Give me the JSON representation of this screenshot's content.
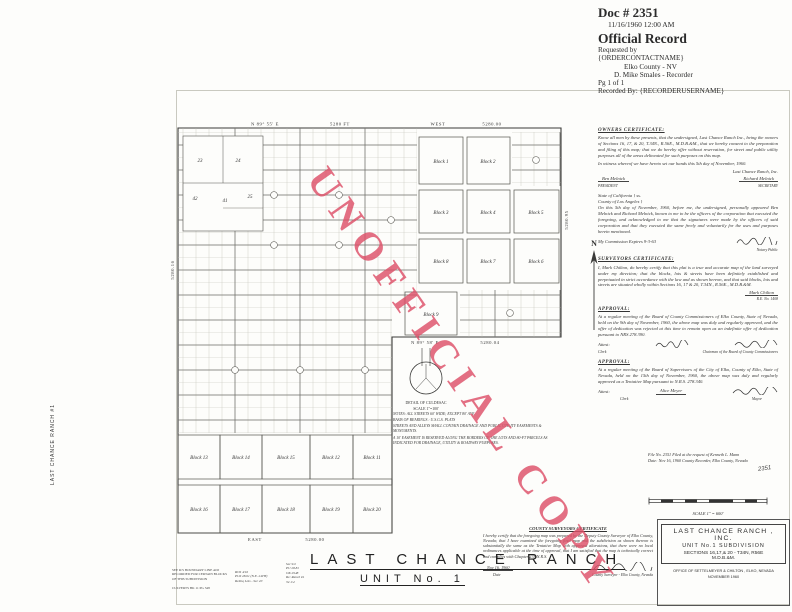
{
  "recorder_header": {
    "doc_number": "Doc # 2351",
    "datetime": "11/16/1960 12:00 AM",
    "record_type": "Official Record",
    "requested_by_label": "Requested by",
    "requested_by": "{ORDERCONTACTNAME}",
    "county": "Elko County - NV",
    "recorder": "D. Mike Smales - Recorder",
    "page": "Pg 1 of 1",
    "recorded_by": "Recorded By: {RECORDERUSERNAME}"
  },
  "watermark": {
    "text": "UNOFFICIAL COPY",
    "color": "#dd4f68"
  },
  "side_tab": {
    "text": "LAST CHANCE RANCH #1"
  },
  "map": {
    "north_label": "N",
    "bearings": {
      "top_left": "N 89° 55' E",
      "top_left_dist": "5280 FT",
      "top_right": "WEST",
      "top_right_dist": "5280.00",
      "right_dist": "5280.95",
      "left_dist": "5280.16",
      "mid_bearing": "N 89° 58' E",
      "mid_dist": "5280.04",
      "bottom_bearing": "EAST",
      "bottom_dist": "5280.00"
    },
    "blocks": {
      "b1": "Block 1",
      "b2": "Block 2",
      "b3": "Block 3",
      "b4": "Block 4",
      "b5": "Block 5",
      "b6": "Block 6",
      "b7": "Block 7",
      "b8": "Block 8",
      "b9": "Block 9",
      "b11": "Block 11",
      "b12": "Block 12",
      "b13": "Block 13",
      "b14": "Block 14",
      "b15": "Block 15",
      "b16": "Block 16",
      "b17": "Block 17",
      "b18": "Block 18",
      "b19": "Block 19",
      "b20": "Block 20"
    },
    "parcels": {
      "p23": "23",
      "p24": "24",
      "p25": "25",
      "p41": "41",
      "p42": "42"
    },
    "detail": {
      "title": "DETAIL OF CULDESAC",
      "scale": "SCALE 1\"=100'"
    },
    "notes": [
      "NOTES:  ALL STREETS 60' WIDE; EXCEPT 80' AVE.",
      "BASIS OF BEARINGS : U.S.G.S. PLATS",
      "STREETS AND ALLEYS SHALL CONTAIN DRAINAGE AND PUBLIC UTILITY EASEMENTS & MONUMENTS.",
      "A 10' EASEMENT IS RESERVED ALONG THE BORDERS OF THE LOTS AND 80-FT PARCELS AS INDICATED FOR DRAINAGE, UTILITY & ROADWAY PURPOSES."
    ]
  },
  "certs": {
    "owners": {
      "heading": "OWNERS  CERTIFICATE:",
      "body": "Know all men by these presents, that the undersigned, Last Chance Ranch Inc., being the owners of Sections 16, 17, & 20, T.34N., R.56E., M.D.B.&M., that we hereby consent to the preparation and filing of this map; that we do hereby offer without reservation, for street and public utility purposes all of the areas delineated for such purposes on this map.",
      "witness": "In witness whereof we have hereto set our hands this 5th day of November, 1960.",
      "company": "Last Chance Ranch, Inc.",
      "sig1": "Ben Melnick",
      "label1": "PRESIDENT",
      "sig2": "Richard Melnick",
      "label2": "SECRETARY"
    },
    "notary": {
      "l1": "State of California   } ss.",
      "l2": "County of Los Angeles }",
      "body": "On this 5th day of November, 1960, before me, the undersigned, personally appeared Ben Melnick and Richard Melnick, known to me to be the officers of the corporation that executed the foregoing, and acknowledged to me that the signatures were made by the officers of said corporation and that they executed the same freely and voluntarily for the uses and purposes herein mentioned.",
      "expires": "My Commission Expires 9-3-63",
      "sig_label": "Notary Public"
    },
    "surveyor": {
      "heading": "SURVEYORS  CERTIFICATE:",
      "body": "I, Mark Chilton, do hereby certify that this plat is a true and accurate map of the land surveyed under my direction; that the blocks, lots & streets have been definitely established and perpetuated in strict accordance with the law and as shown hereon, and that said blocks, lots and streets are situated wholly within Sections 16, 17 & 20, T.34N., R.56E., M.D.B.&M.",
      "sig": "Mark Chilton",
      "reg": "R.E. No. 1408"
    },
    "approval1": {
      "heading": "APPROVAL:",
      "body": "At a regular meeting of the Board of County Commissioners of Elko County, State of Nevada, held on the 9th day of November, 1960, the above map was duly and regularly approved, and the offer of dedication was rejected at this time to remain open as an indefinite offer of dedication pursuant to NRS 278.390.",
      "attest": "Attest:",
      "label1": "Clerk",
      "label2": "Chairman of the Board of County Commissioners"
    },
    "approval2": {
      "heading": "APPROVAL:",
      "body": "At a regular meeting of the Board of Supervisors of the City of Elko, County of Elko, State of Nevada, held on the 15th day of November, 1960, the above map was duly and regularly approved as a Tentative Map pursuant to N.R.S. 278.340.",
      "attest": "Attest:",
      "sig1": "Alice Meyer",
      "label1": "Clerk",
      "label2": "Mayor"
    },
    "file": {
      "line1": "File No. 2351      Filed at the request of  Kenneth L. Mann",
      "line2": "Date:  Nov 16, 1960      County Recorder, Elko County, Nevada",
      "stamp": "2351"
    }
  },
  "scale_bar": {
    "label": "SCALE  1\" = 600'"
  },
  "county_cert": {
    "heading": "COUNTY  SURVEYORS  CERTIFICATE",
    "body": "I hereby certify that the foregoing map was prepared by the Deputy County Surveyor of Elko County, Nevada; that I have examined the foregoing final map and the subdivision as shown thereon is substantially the same as the Tentative Map with approved alterations, that there were no local ordinances applicable at the time of approval, that I am satisfied that the map is technically correct and complies with Chapter 278  N.R.S.",
    "date": "Nov 16, 1960",
    "date_label": "Date",
    "sig_label": "County Surveyor - Elko County, Nevada"
  },
  "main_title": {
    "line1": "LAST  CHANCE  RANCH",
    "line2": "UNIT  No. 1"
  },
  "title_block": {
    "line1": "LAST CHANCE RANCH , INC.",
    "line2": "UNIT No.1  SUBDIVISION",
    "line3": "SECTIONS 16,17,& 20 - T34N, R56E",
    "line4": "M.D.B.&M.",
    "office": "OFFICE OF  SETTELMEYER & CHILTON ,  ELKO, NEVADA",
    "date": "NOVEMBER 1960"
  },
  "margin_notes": {
    "stamp1": [
      "SEE R/S BOUNDARY LINE ADJ",
      "RECORDED FOR CERTAIN BLOCKS",
      "OF THIS SUBDIVISION",
      "CULVERTS BK 11 PG 348"
    ],
    "hand1": [
      "ROS 4/16",
      "PU# 28.61 (N.E. 24TH)",
      "Relinq Lots - Sec 20"
    ],
    "hand2": [
      "Sec 9/2",
      "PU 28.81",
      "OK 2948",
      "Re: Ranch #1",
      "34 1/4"
    ]
  }
}
